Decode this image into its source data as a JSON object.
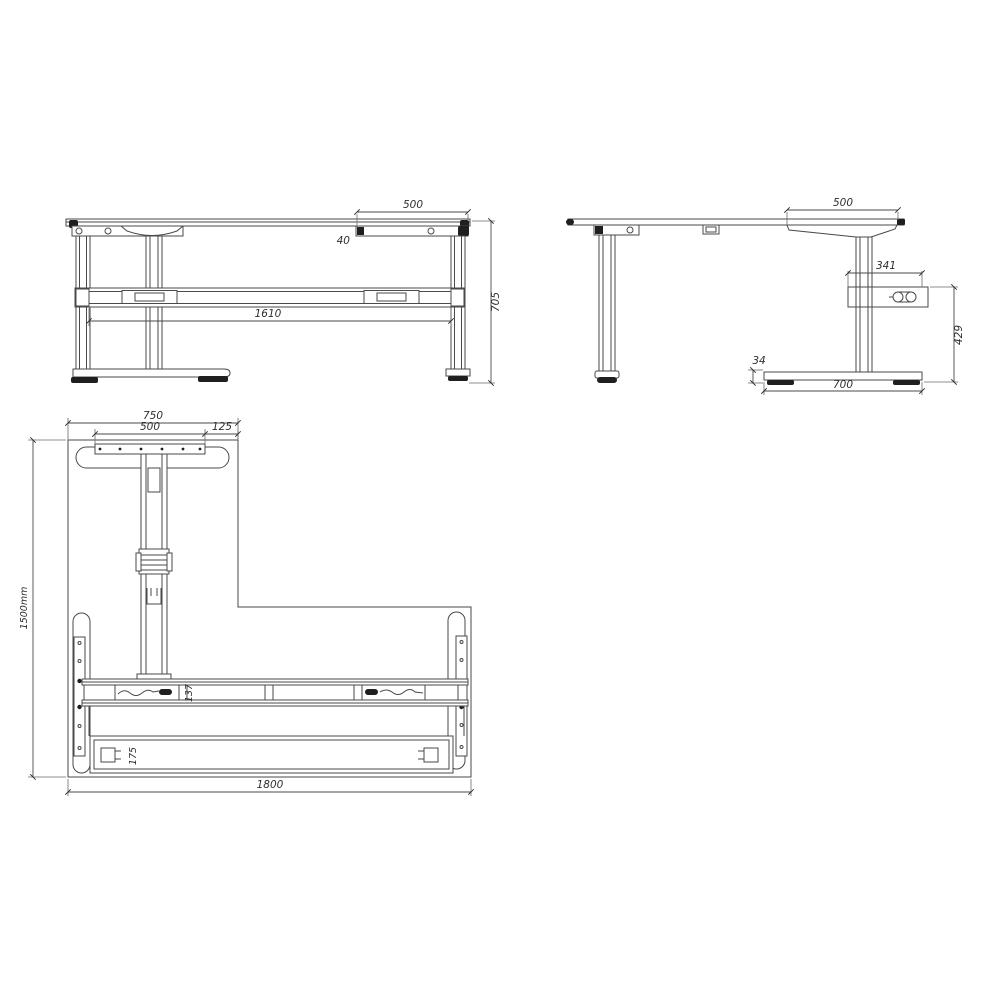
{
  "drawing": {
    "type": "technical-drawing",
    "subject": "height-adjustable L-shaped desk frame, three orthographic views",
    "colors": {
      "line": "#4a4a4a",
      "dark_fill": "#1f1f1f",
      "text": "#2e2e2e",
      "background": "#ffffff"
    }
  },
  "views": {
    "front": {
      "label": "front-view",
      "dims": {
        "bracket_width": "500",
        "top_offset": "40",
        "beam_span": "1610",
        "total_height": "705"
      }
    },
    "side": {
      "label": "side-view",
      "dims": {
        "bracket_width": "500",
        "control_box_depth": "341",
        "column_height": "429",
        "foot_height": "34",
        "foot_depth": "700"
      }
    },
    "plan": {
      "label": "plan-bottom-view",
      "dims": {
        "arm_width": "750",
        "foot_plate_width": "500",
        "plate_edge_gap": "125",
        "desk_depth": "1500mm",
        "beam_width": "137",
        "rail_width": "175",
        "desk_width": "1800"
      }
    }
  }
}
